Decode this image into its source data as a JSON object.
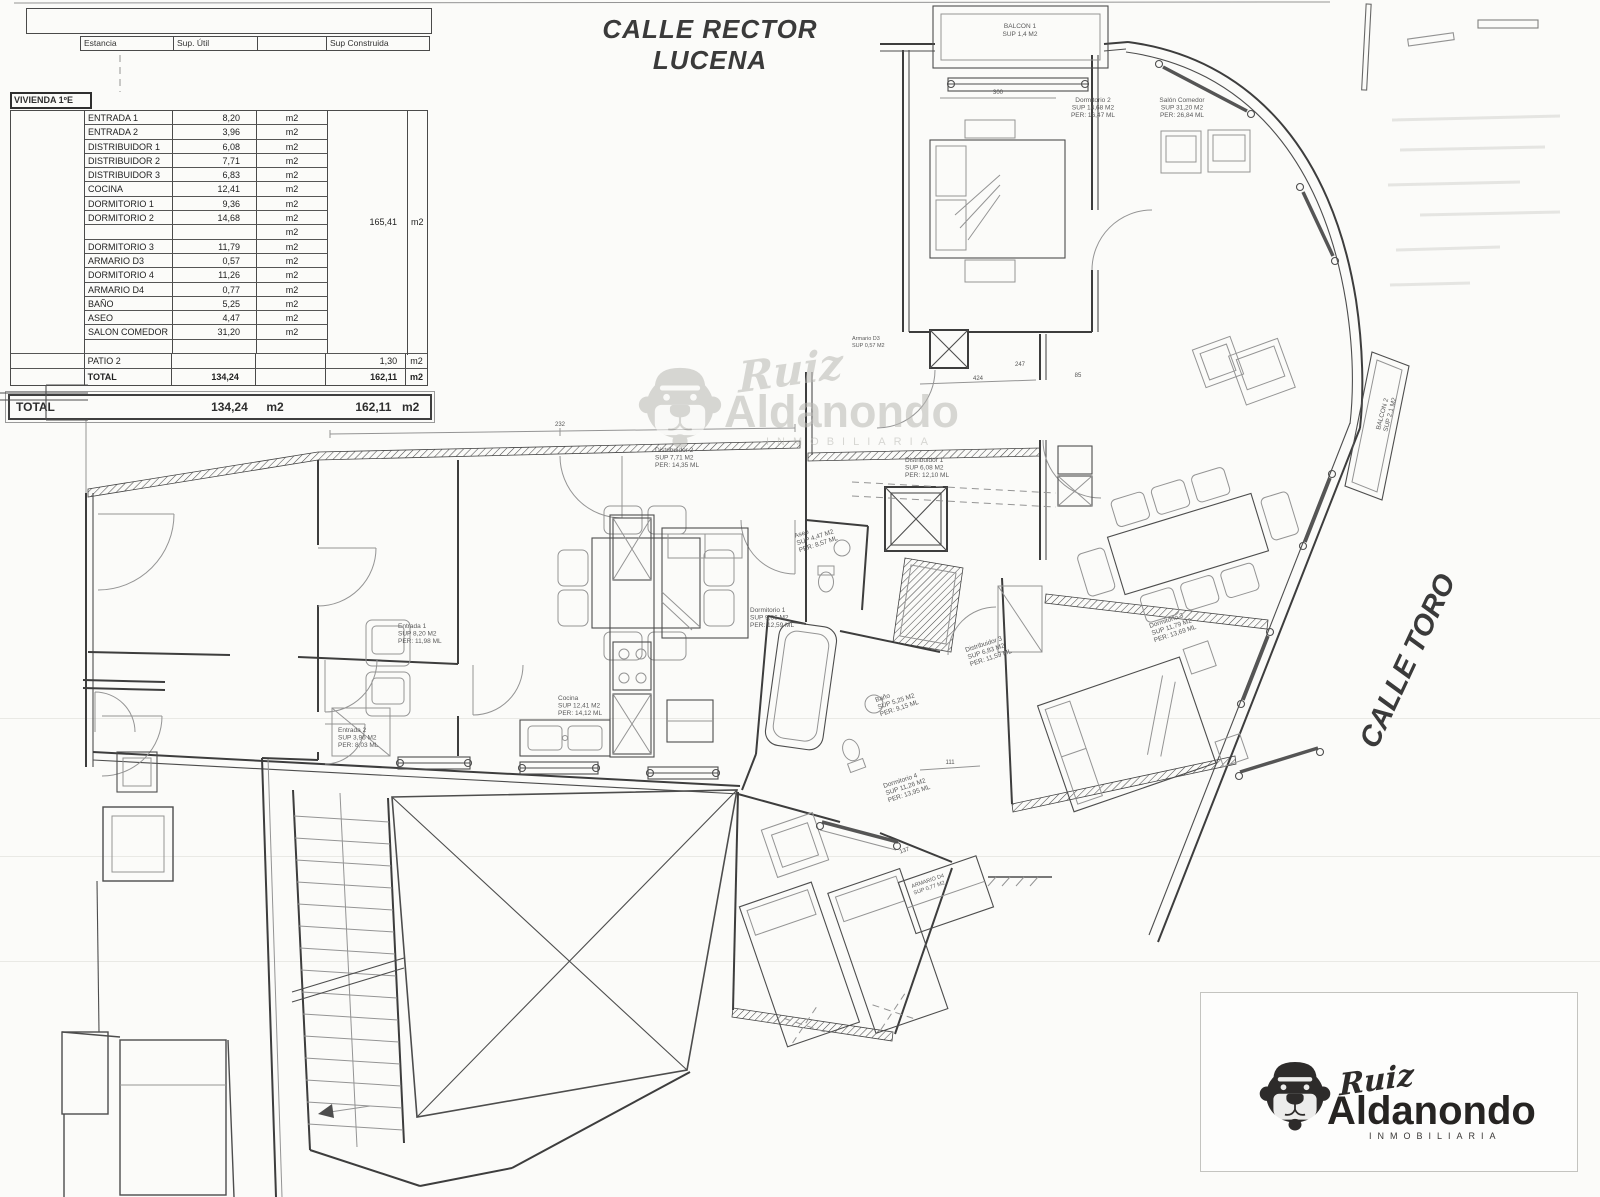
{
  "streets": {
    "top": "CALLE RECTOR LUCENA",
    "right": "CALLE TORO"
  },
  "area_table": {
    "header": {
      "estancia": "Estancia",
      "sup_util": "Sup. Útil",
      "sup_construida": "Sup Construida"
    },
    "unit_label": "VIVIENDA 1ºE",
    "rows": [
      {
        "name": "ENTRADA 1",
        "sup": "8,20",
        "unit": "m2"
      },
      {
        "name": "ENTRADA 2",
        "sup": "3,96",
        "unit": "m2"
      },
      {
        "name": "DISTRIBUIDOR 1",
        "sup": "6,08",
        "unit": "m2"
      },
      {
        "name": "DISTRIBUIDOR 2",
        "sup": "7,71",
        "unit": "m2"
      },
      {
        "name": "DISTRIBUIDOR 3",
        "sup": "6,83",
        "unit": "m2"
      },
      {
        "name": "COCINA",
        "sup": "12,41",
        "unit": "m2"
      },
      {
        "name": "DORMITORIO 1",
        "sup": "9,36",
        "unit": "m2"
      },
      {
        "name": "DORMITORIO 2",
        "sup": "14,68",
        "unit": "m2"
      },
      {
        "name": "",
        "sup": "",
        "unit": "m2"
      },
      {
        "name": "DORMITORIO 3",
        "sup": "11,79",
        "unit": "m2"
      },
      {
        "name": "ARMARIO D3",
        "sup": "0,57",
        "unit": "m2"
      },
      {
        "name": "DORMITORIO 4",
        "sup": "11,26",
        "unit": "m2"
      },
      {
        "name": "ARMARIO D4",
        "sup": "0,77",
        "unit": "m2"
      },
      {
        "name": "BAÑO",
        "sup": "5,25",
        "unit": "m2"
      },
      {
        "name": "ASEO",
        "sup": "4,47",
        "unit": "m2"
      },
      {
        "name": "SALON COMEDOR",
        "sup": "31,20",
        "unit": "m2"
      }
    ],
    "construida": {
      "value": "165,41",
      "unit": "m2"
    },
    "patio_row": {
      "name": "PATIO 2",
      "construida": "1,30",
      "unit": "m2"
    },
    "total_row": {
      "name": "TOTAL",
      "sup": "134,24",
      "construida": "162,11",
      "unit": "m2"
    },
    "grand_total": {
      "label": "TOTAL",
      "sup": "134,24",
      "sup_unit": "m2",
      "construida": "162,11",
      "construida_unit": "m2"
    }
  },
  "brand": {
    "script": "Ruiz",
    "name": "Aldanondo",
    "subtitle": "INMOBILIARIA"
  },
  "plan_labels": {
    "balcon1": {
      "l1": "BALCON 1",
      "l2": "SUP 1,4 M2"
    },
    "dorm2": {
      "l1": "Dormitorio 2",
      "l2": "SUP 14,68 M2",
      "l3": "PER: 16,47 ML"
    },
    "salon": {
      "l1": "Salón Comedor",
      "l2": "SUP 31,20 M2",
      "l3": "PER: 26,84 ML"
    },
    "armario_d3": {
      "l1": "Armario D3",
      "l2": "SUP 0,57 M2"
    },
    "balcon2": {
      "l1": "BALCON 2",
      "l2": "SUP 2,1 M2"
    },
    "dist1": {
      "l1": "Distribuidor 1",
      "l2": "SUP 6,08 M2",
      "l3": "PER: 12,10 ML"
    },
    "dist2": {
      "l1": "Distribuidor 2",
      "l2": "SUP 7,71 M2",
      "l3": "PER: 14,35 ML"
    },
    "dist3": {
      "l1": "Distribuidor 3",
      "l2": "SUP 6,83 M2",
      "l3": "PER: 11,59 ML"
    },
    "entrada1": {
      "l1": "Entrada 1",
      "l2": "SUP 8,20 M2",
      "l3": "PER: 11,98 ML"
    },
    "entrada2": {
      "l1": "Entrada 2",
      "l2": "SUP 3,96 M2",
      "l3": "PER: 8,03 ML"
    },
    "cocina": {
      "l1": "Cocina",
      "l2": "SUP 12,41 M2",
      "l3": "PER: 14,12 ML"
    },
    "dorm1": {
      "l1": "Dormitorio 1",
      "l2": "SUP 9,36 M2",
      "l3": "PER: 12,59 ML"
    },
    "aseo": {
      "l1": "Aseo",
      "l2": "SUP 4,47 M2",
      "l3": "PER: 8,57 ML"
    },
    "bano": {
      "l1": "Baño",
      "l2": "SUP 5,25 M2",
      "l3": "PER: 9,15 ML"
    },
    "dorm3": {
      "l1": "Dormitorio 3",
      "l2": "SUP 11,79 M2",
      "l3": "PER: 13,69 ML"
    },
    "dorm4": {
      "l1": "Dormitorio 4",
      "l2": "SUP 11,26 M2",
      "l3": "PER: 13,95 ML"
    },
    "armario_d4": {
      "l1": "ARMARIO D4",
      "l2": "SUP 0,77 M2"
    }
  },
  "dims": {
    "d1": "300",
    "d2": "424",
    "d3": "247",
    "d4": "85",
    "d5": "232",
    "d6": "111",
    "d7": "137"
  }
}
